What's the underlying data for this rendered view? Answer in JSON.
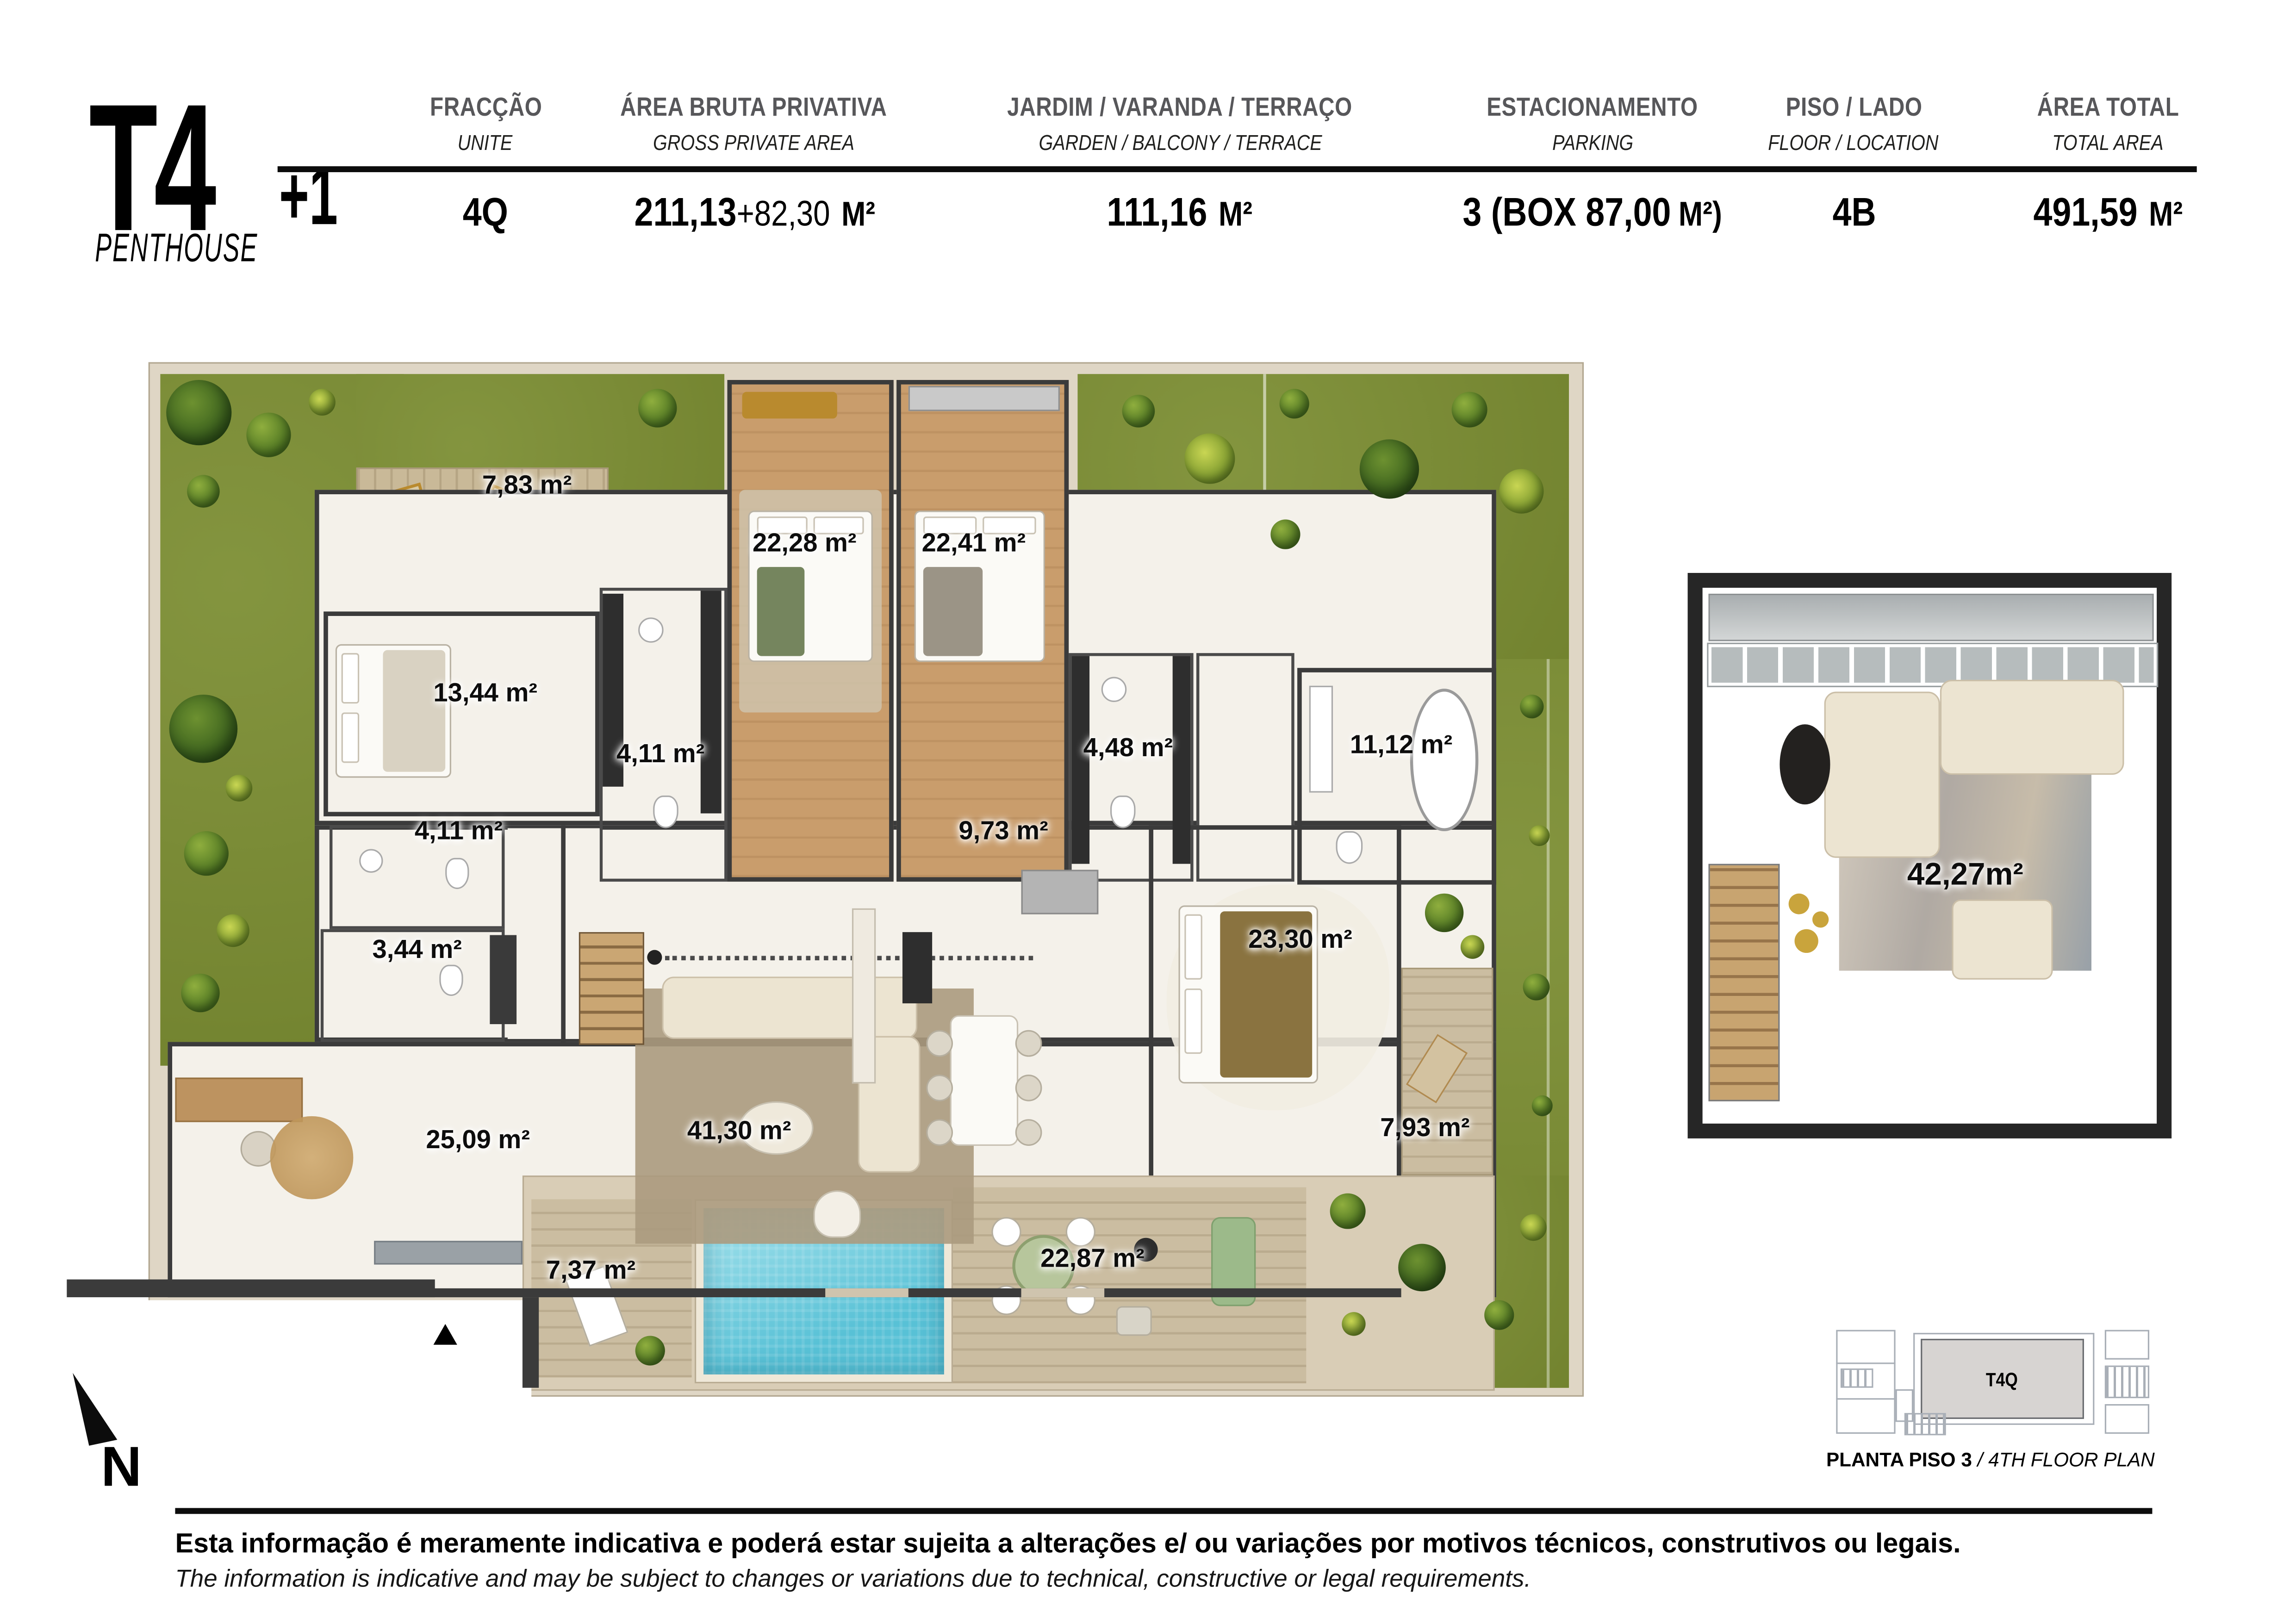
{
  "header": {
    "logo": {
      "main": "T4",
      "suffix": "+1",
      "subtitle": "PENTHOUSE"
    },
    "columns": [
      {
        "label_pt": "FRACÇÃO",
        "label_en": "UNITE",
        "value_main": "4Q",
        "value_extra": "",
        "value_unit": ""
      },
      {
        "label_pt": "ÁREA BRUTA PRIVATIVA",
        "label_en": "GROSS PRIVATE AREA",
        "value_main": "211,13",
        "value_extra": "+82,30",
        "value_unit": "M²"
      },
      {
        "label_pt": "JARDIM / VARANDA / TERRAÇO",
        "label_en": "GARDEN / BALCONY / TERRACE",
        "value_main": "111,16",
        "value_extra": "",
        "value_unit": "M²"
      },
      {
        "label_pt": "ESTACIONAMENTO",
        "label_en": "PARKING",
        "value_main": "3 (BOX 87,00",
        "value_extra": "",
        "value_unit": "M²)"
      },
      {
        "label_pt": "PISO / LADO",
        "label_en": "FLOOR / LOCATION",
        "value_main": "4B",
        "value_extra": "",
        "value_unit": ""
      },
      {
        "label_pt": "ÁREA TOTAL",
        "label_en": "TOTAL AREA",
        "value_main": "491,59",
        "value_extra": "",
        "value_unit": "M²"
      }
    ]
  },
  "floor_plan": {
    "rooms": [
      {
        "name": "terrace-deck",
        "label": "7,83 m²"
      },
      {
        "name": "bedroom-2",
        "label": "22,28 m²"
      },
      {
        "name": "bedroom-3",
        "label": "22,41 m²"
      },
      {
        "name": "bedroom-1",
        "label": "13,44 m²"
      },
      {
        "name": "bathroom-top",
        "label": "4,11 m²"
      },
      {
        "name": "bathroom-mid",
        "label": "4,48 m²"
      },
      {
        "name": "bathroom-master",
        "label": "11,12 m²"
      },
      {
        "name": "wc-left",
        "label": "4,11 m²"
      },
      {
        "name": "hall",
        "label": "9,73 m²"
      },
      {
        "name": "wc-small",
        "label": "3,44 m²"
      },
      {
        "name": "master-bedroom",
        "label": "23,30 m²"
      },
      {
        "name": "office",
        "label": "25,09 m²"
      },
      {
        "name": "living-room",
        "label": "41,30 m²"
      },
      {
        "name": "deck-right",
        "label": "7,93 m²"
      },
      {
        "name": "pool-deck",
        "label": "7,37 m²"
      },
      {
        "name": "terrace-south",
        "label": "22,87 m²"
      }
    ]
  },
  "upper_plan": {
    "label": "42,27m²"
  },
  "mini_plan": {
    "unit": "T4Q",
    "caption_pt": "PLANTA PISO 3",
    "caption_en": " / 4TH FLOOR PLAN"
  },
  "compass": {
    "label": "N"
  },
  "footer": {
    "line1": "Esta informação é meramente indicativa e poderá estar sujeita a alterações e/ ou variações por motivos técnicos, construtivos ou legais.",
    "line2": "The information is indicative and may be subject to changes or variations due to technical, constructive or legal requirements."
  },
  "colors": {
    "grass": "#7c8e33",
    "water": "#6cc8da",
    "wood": "#c99d6c",
    "wall": "#3b3b3b",
    "stone": "#d9cdb6"
  }
}
